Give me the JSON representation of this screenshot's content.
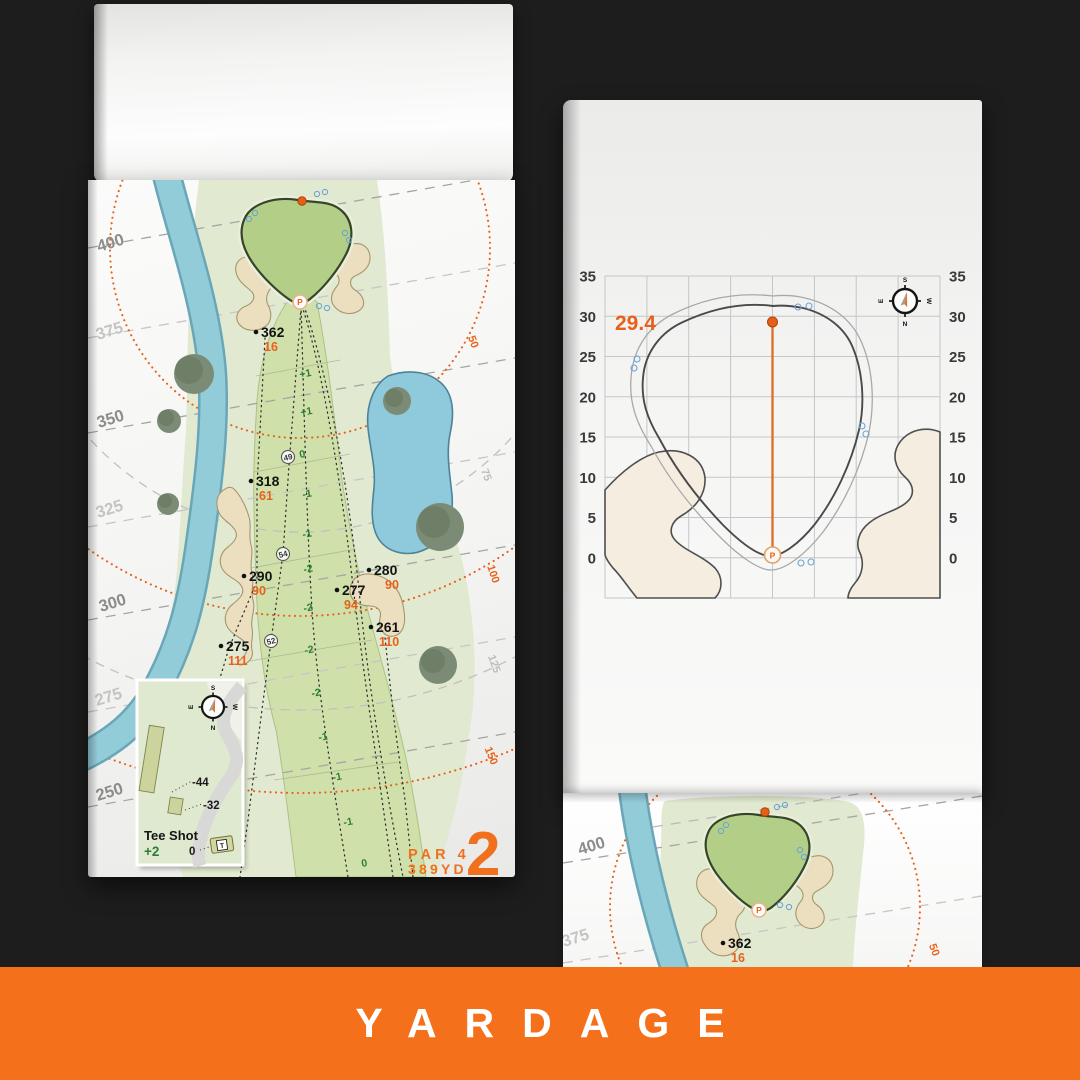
{
  "banner": {
    "label": "YARDAGE",
    "bg_color": "#f4701a"
  },
  "colors": {
    "accent_orange": "#ee6e1d",
    "water": "#93ccd9",
    "fairway": "#cfe0aa",
    "green": "#b3cf87",
    "sand": "#ecdfc0",
    "rough": "#e1ead0"
  },
  "compass": {
    "n": "N",
    "s": "S",
    "e": "E",
    "w": "W"
  },
  "hole_page": {
    "bands": [
      "400",
      "375",
      "350",
      "325",
      "300",
      "275",
      "250"
    ],
    "rings": {
      "orange": [
        "50",
        "100",
        "150"
      ],
      "gray": [
        "75",
        "125"
      ]
    },
    "markers": [
      {
        "d": "362",
        "f": "16"
      },
      {
        "d": "318",
        "f": "61"
      },
      {
        "d": "290",
        "f": "90"
      },
      {
        "d": "275",
        "f": "111"
      },
      {
        "d": "280",
        "f": "90"
      },
      {
        "d": "277",
        "f": "94"
      },
      {
        "d": "261",
        "f": "110"
      }
    ],
    "widths": [
      "49",
      "54",
      "52"
    ],
    "elev": [
      "+1",
      "+1",
      "0",
      "-1",
      "-1",
      "-2",
      "-2",
      "-2",
      "-2",
      "-1",
      "-1",
      "-1",
      "0"
    ],
    "pin": "P",
    "inset": {
      "title": "Tee Shot",
      "score": "+2",
      "back": "-44",
      "front": "-32",
      "zero": "0",
      "tee": "T"
    },
    "par_label": "PAR 4",
    "yardage_label": "389YD",
    "hole_number": "2"
  },
  "green_page": {
    "depth_value": "29.4",
    "ticks": [
      "35",
      "30",
      "25",
      "20",
      "15",
      "10",
      "5",
      "0"
    ],
    "pin": "P"
  },
  "next_page": {
    "bands": [
      "400",
      "375"
    ],
    "marker": {
      "d": "362",
      "f": "16"
    },
    "ring": "50",
    "pin": "P"
  }
}
